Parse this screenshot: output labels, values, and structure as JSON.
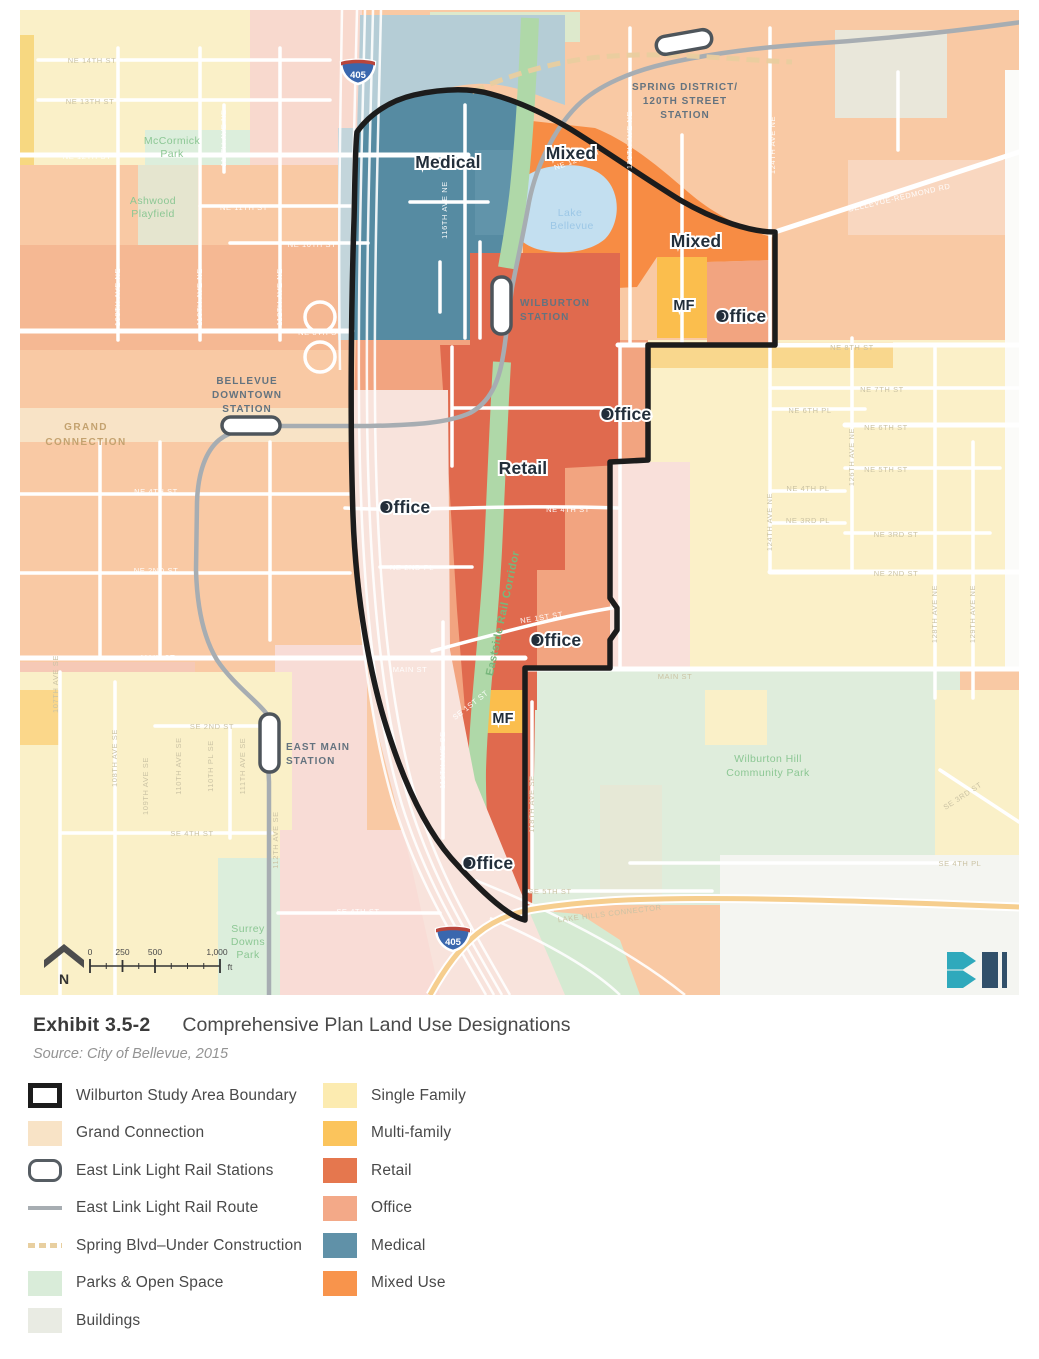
{
  "caption": {
    "exhibit": "Exhibit 3.5-2",
    "title": "Comprehensive Plan Land Use Designations",
    "source": "Source: City of Bellevue, 2015"
  },
  "legend": {
    "left": [
      "Wilburton Study Area Boundary",
      "Grand Connection",
      "East Link Light Rail Stations",
      "East Link Light Rail Route",
      "Spring Blvd–Under Construction",
      "Parks & Open Space",
      "Buildings"
    ],
    "right": [
      "Single Family",
      "Multi-family",
      "Retail",
      "Office",
      "Medical",
      "Mixed Use"
    ]
  },
  "colors": {
    "single_family": "#FCEBB0",
    "multi_family": "#FBC45C",
    "retail": "#E5774E",
    "office": "#F3A988",
    "medical": "#6091A8",
    "mixed_use": "#F8944C",
    "grand_connection": "#F8E3C6",
    "parks_open_space": "#D9ECD9",
    "buildings": "#E9EBE3",
    "rail_route": "#A7ADB2",
    "boundary": "#1C1C1C",
    "lake": "#C3DFF0",
    "map_background": "#F9C9A4"
  },
  "map": {
    "north_label": "N",
    "scale": {
      "ticks": [
        "0",
        "250",
        "500",
        "1,000"
      ],
      "unit": "ft"
    },
    "highway_shield": "405",
    "stations": [
      [
        "SPRING DISTRICT/",
        "120TH STREET",
        "STATION"
      ],
      [
        "WILBURTON",
        "STATION"
      ],
      [
        "BELLEVUE",
        "DOWNTOWN",
        "STATION"
      ],
      [
        "EAST MAIN",
        "STATION"
      ]
    ],
    "grand_connection": [
      "GRAND",
      "CONNECTION"
    ],
    "lake_label": [
      "Lake",
      "Bellevue"
    ],
    "corridor_label": "Eastside Rail Corridor",
    "land_use_labels": [
      "Medical",
      "Mixed",
      "Mixed",
      "MF",
      "Office",
      "Office",
      "Retail",
      "Office",
      "Office",
      "MF",
      "Office"
    ],
    "area_labels": {
      "mccormick": [
        "McCormick",
        "Park"
      ],
      "ashwood": [
        "Ashwood",
        "Playfield"
      ],
      "surrey": [
        "Surrey",
        "Downs",
        "Park"
      ],
      "wilburton_hill": [
        "Wilburton Hill",
        "Community Park"
      ]
    },
    "street_labels": [
      "NE 14TH ST",
      "NE 13TH ST",
      "NE 12TH ST",
      "111TH AVE NE",
      "NE 11TH ST",
      "NE 10TH ST",
      "108TH AVE NE",
      "110TH AVE NE",
      "112TH AVE NE",
      "NE 8TH ST",
      "NE 8TH ST",
      "NE 7TH ST",
      "NE 6TH PL",
      "NE 6TH ST",
      "NE 5TH ST",
      "NE 4TH PL",
      "NE 3RD PL",
      "NE 3RD ST",
      "NE 2ND ST",
      "120TH AVE NE",
      "124TH AVE NE",
      "124TH AVE NE",
      "126TH AVE NE",
      "128TH AVE NE",
      "129TH AVE NE",
      "BELLEVUE-REDMOND RD",
      "NE 4TH ST",
      "NE 2ND PL",
      "NE 1ST ST",
      "MAIN ST",
      "MAIN ST",
      "SE 1ST ST",
      "116TH AVE SE",
      "118TH AVE SE",
      "MAIN ST",
      "SE 2ND ST",
      "SE 4TH ST",
      "107TH AVE SE",
      "108TH AVE SE",
      "109TH AVE SE",
      "110TH AVE SE",
      "110TH PL SE",
      "111TH AVE SE",
      "112TH AVE SE",
      "SE 4TH ST",
      "SE 3RD ST",
      "SE 4TH PL",
      "SE 5TH ST",
      "LAKE HILLS CONNECTOR",
      "NE 2ND ST",
      "NE 4TH ST",
      "NE 12TH ST",
      "116TH AVE NE"
    ]
  }
}
